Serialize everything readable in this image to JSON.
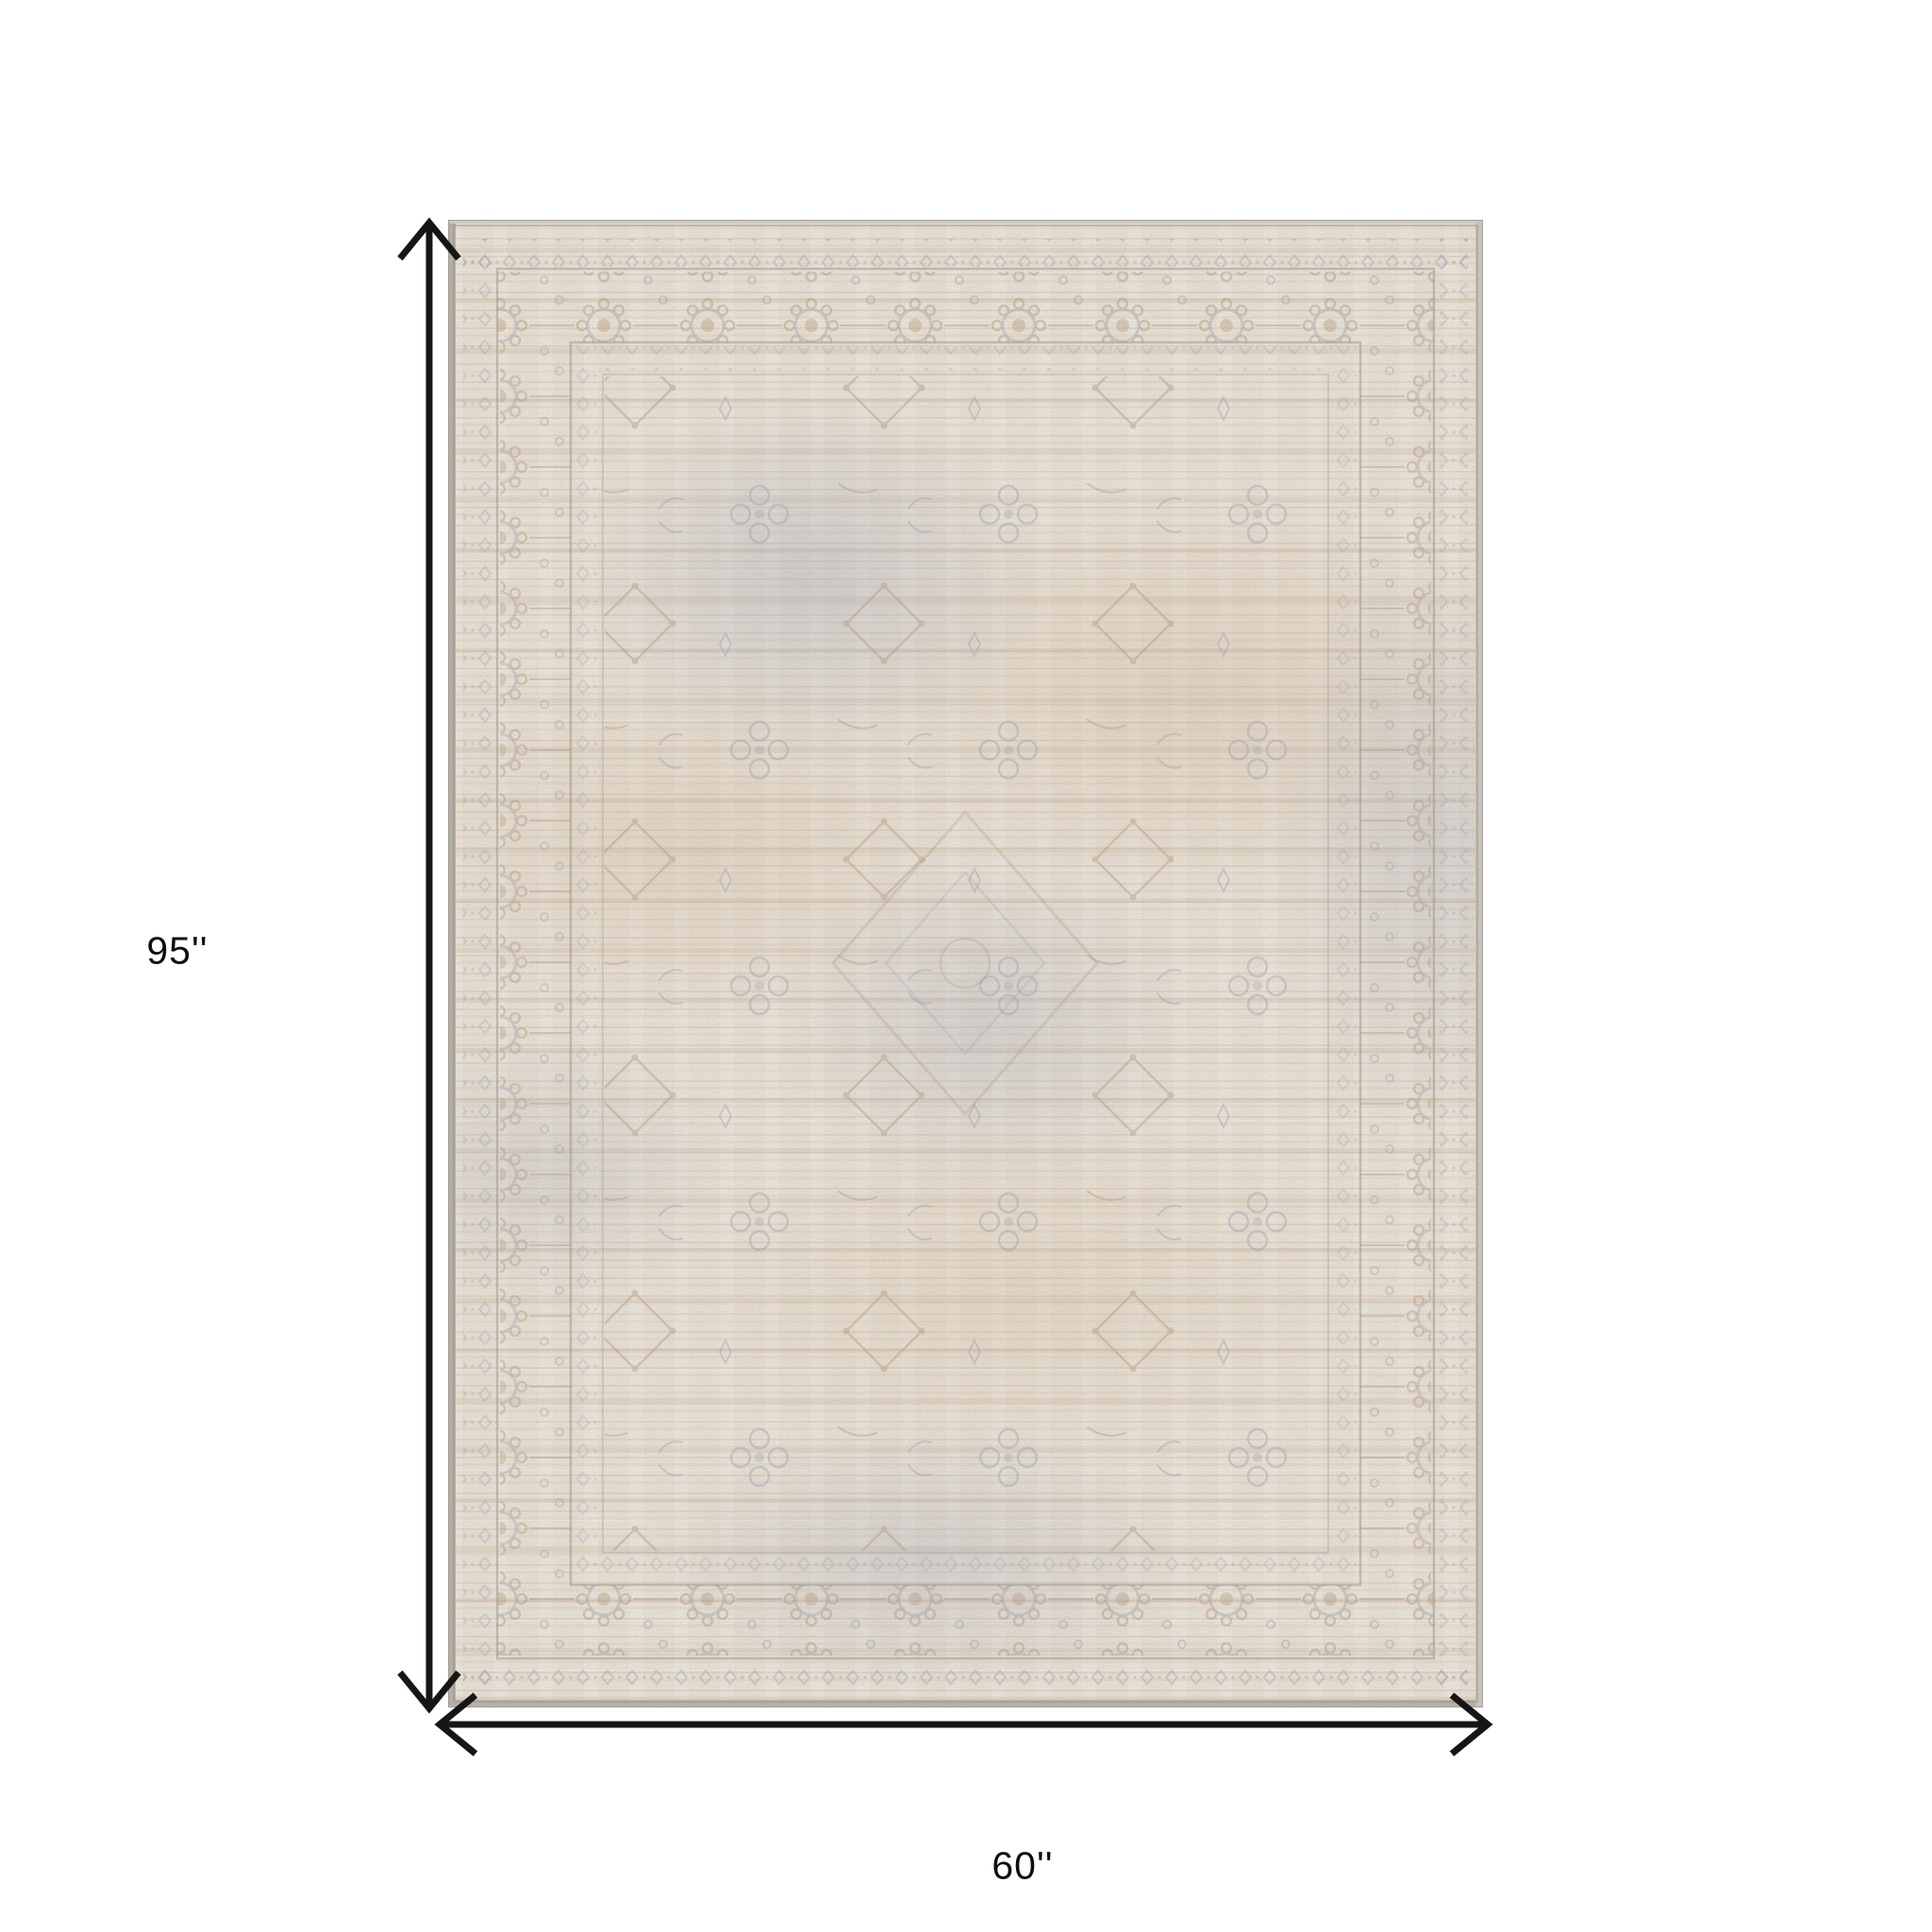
{
  "page": {
    "background_color": "#ffffff"
  },
  "dimensions": {
    "height_label": "95''",
    "width_label": "60''",
    "arrow_color": "#161616",
    "label_color": "#0e0e0e"
  },
  "rug": {
    "description": "distressed vintage oriental area rug, faded beige and gray-blue allover pattern with bordered frame",
    "base_color": "#e7e0d5",
    "tan_accent_color": "#c2a789",
    "blue_gray_accent_color": "#9aa1b4",
    "edge_color": "#b1ada5"
  }
}
